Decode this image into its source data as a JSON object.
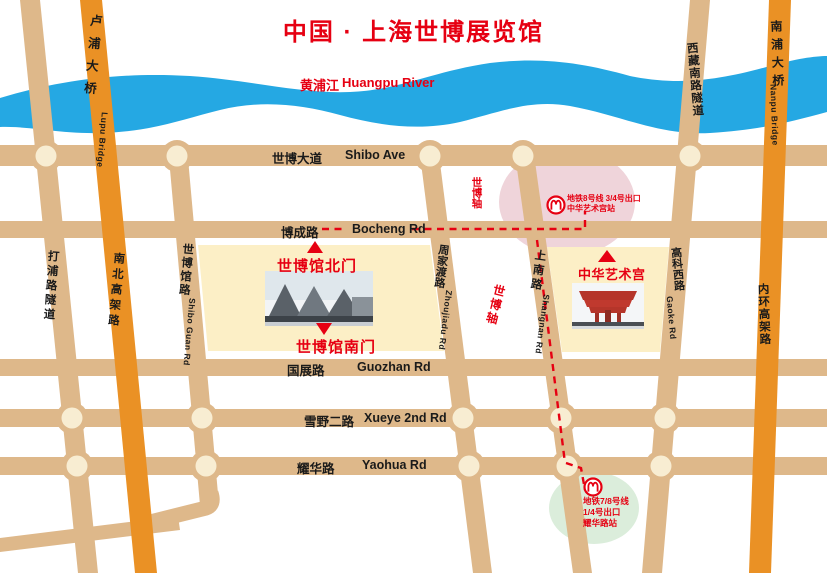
{
  "title": "中国 · 上海世博展览馆",
  "river": {
    "name_zh": "黄浦江",
    "name_en": "Huangpu River"
  },
  "roads": {
    "horizontal": [
      {
        "zh": "世博大道",
        "en": "Shibo Ave"
      },
      {
        "zh": "博成路",
        "en": "Bocheng Rd"
      },
      {
        "zh": "国展路",
        "en": "Guozhan Rd"
      },
      {
        "zh": "雪野二路",
        "en": "Xueye 2nd Rd"
      },
      {
        "zh": "耀华路",
        "en": "Yaohua Rd"
      }
    ],
    "vertical": [
      {
        "zh": "打浦路隧道",
        "en": ""
      },
      {
        "zh": "卢浦大桥",
        "en": "Lupu Bridge"
      },
      {
        "zh": "南北高架路",
        "en": ""
      },
      {
        "zh": "世博馆路",
        "en": "Shibo Guan Rd"
      },
      {
        "zh": "周家渡路",
        "en": "Zhoujiadu Rd"
      },
      {
        "zh": "上南路",
        "en": "Shangnan Rd"
      },
      {
        "zh": "西藏南路隧道",
        "en": ""
      },
      {
        "zh": "高科西路",
        "en": "Gaoke Rd"
      },
      {
        "zh": "南浦大桥",
        "en": "Nanpu Bridge"
      },
      {
        "zh": "内环高架路",
        "en": ""
      }
    ]
  },
  "expo_axis": {
    "label": "世博轴"
  },
  "landmarks": {
    "north_gate": "世博馆北门",
    "south_gate": "世博馆南门",
    "art_palace": "中华艺术宫"
  },
  "metro": {
    "station1": {
      "line1": "地铁8号线 3/4号出口",
      "line2": "中华艺术宫站"
    },
    "station2": {
      "line1": "地铁7/8号线",
      "line2": "1/4号出口",
      "line3": "耀华路站"
    }
  },
  "colors": {
    "road_tan": "#DEB88A",
    "roundabout_center": "#F8EDD2",
    "highway_orange": "#EA9125",
    "river_blue": "#25A8E3",
    "block_yellow": "#FCEFC6",
    "accent_red": "#E60012",
    "pink_zone": "#EFD4DA",
    "green_zone": "#DBEDDB"
  }
}
